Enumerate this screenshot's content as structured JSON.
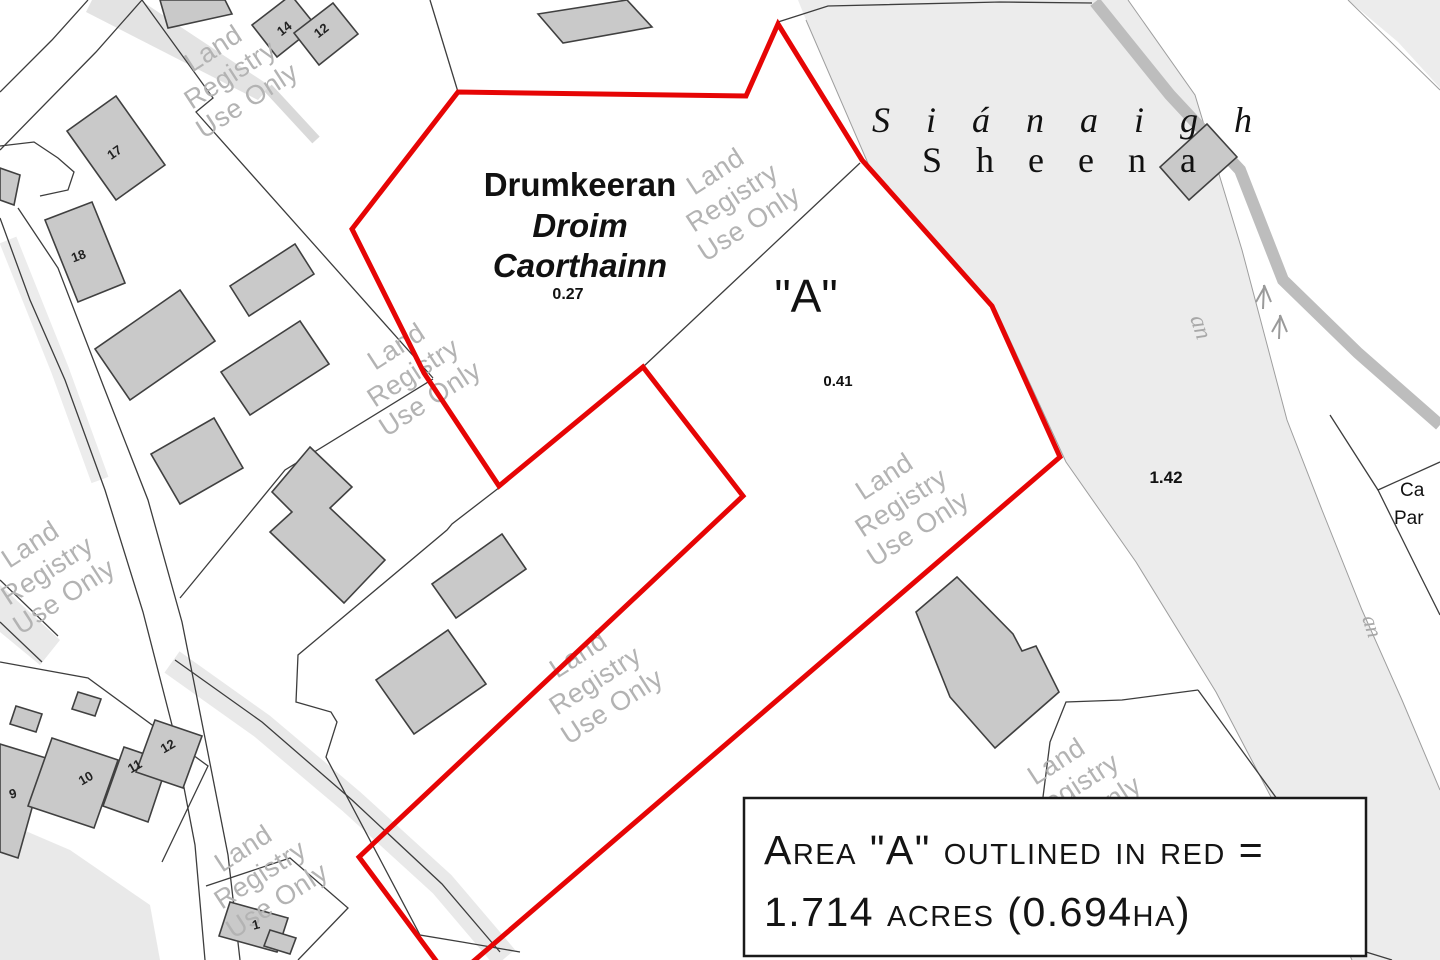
{
  "map": {
    "townland_label": {
      "name": "Drumkeeran",
      "irish_name_line1": "Droim",
      "irish_name_line2": "Caorthainn",
      "area_value": "0.27"
    },
    "parcel_a": {
      "label": "\"A\"",
      "area_value": "0.41"
    },
    "river_parcel_area": "1.42",
    "river_name": {
      "italic_spread": "Siánaigh",
      "roman_spread": "Sheena"
    },
    "clipped_labels": {
      "line1": "Ca",
      "line2": "Par"
    },
    "watermark": {
      "line1": "Land",
      "line2": "Registry",
      "line3": "Use Only"
    },
    "building_numbers": {
      "n14": "14",
      "n12": "12",
      "n17": "17",
      "n18": "18",
      "n9": "9",
      "n10": "10",
      "n11": "11",
      "n12b": "12",
      "n1": "1"
    },
    "stream_letters": "an",
    "note_box": {
      "line1": "Area \"A\" outlined in red =",
      "line2": "1.714 acres (0.694ha)"
    },
    "colors": {
      "outline_red": "#e60505",
      "building_fill": "#c9c9c9",
      "river_fill": "#ececec",
      "stream_band": "#bdbdbd",
      "watermark_gray": "#b3b3b3",
      "boundary": "#3d3d3d"
    }
  }
}
